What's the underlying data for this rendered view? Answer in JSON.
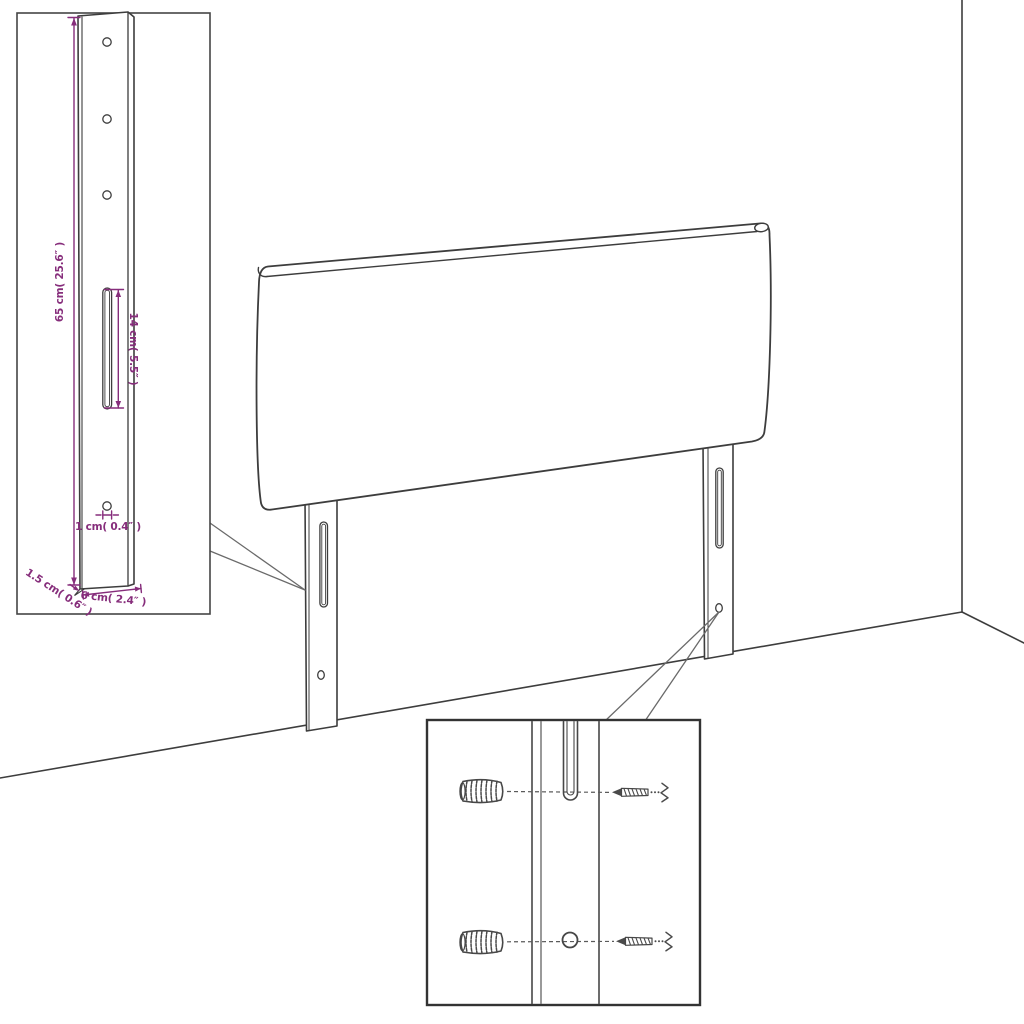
{
  "diagram": {
    "colors": {
      "outline": "#3d3d3d",
      "dimension": "#862d7b",
      "background": "#ffffff"
    },
    "leg_detail": {
      "height": "65 cm( 25.6″ )",
      "slot_height": "14 cm( 5.5″ )",
      "hole_diameter": "1 cm( 0.4″ )",
      "bottom_thickness": "1.5 cm( 0.6″ )",
      "leg_width": "6 cm( 2.4″ )"
    }
  }
}
